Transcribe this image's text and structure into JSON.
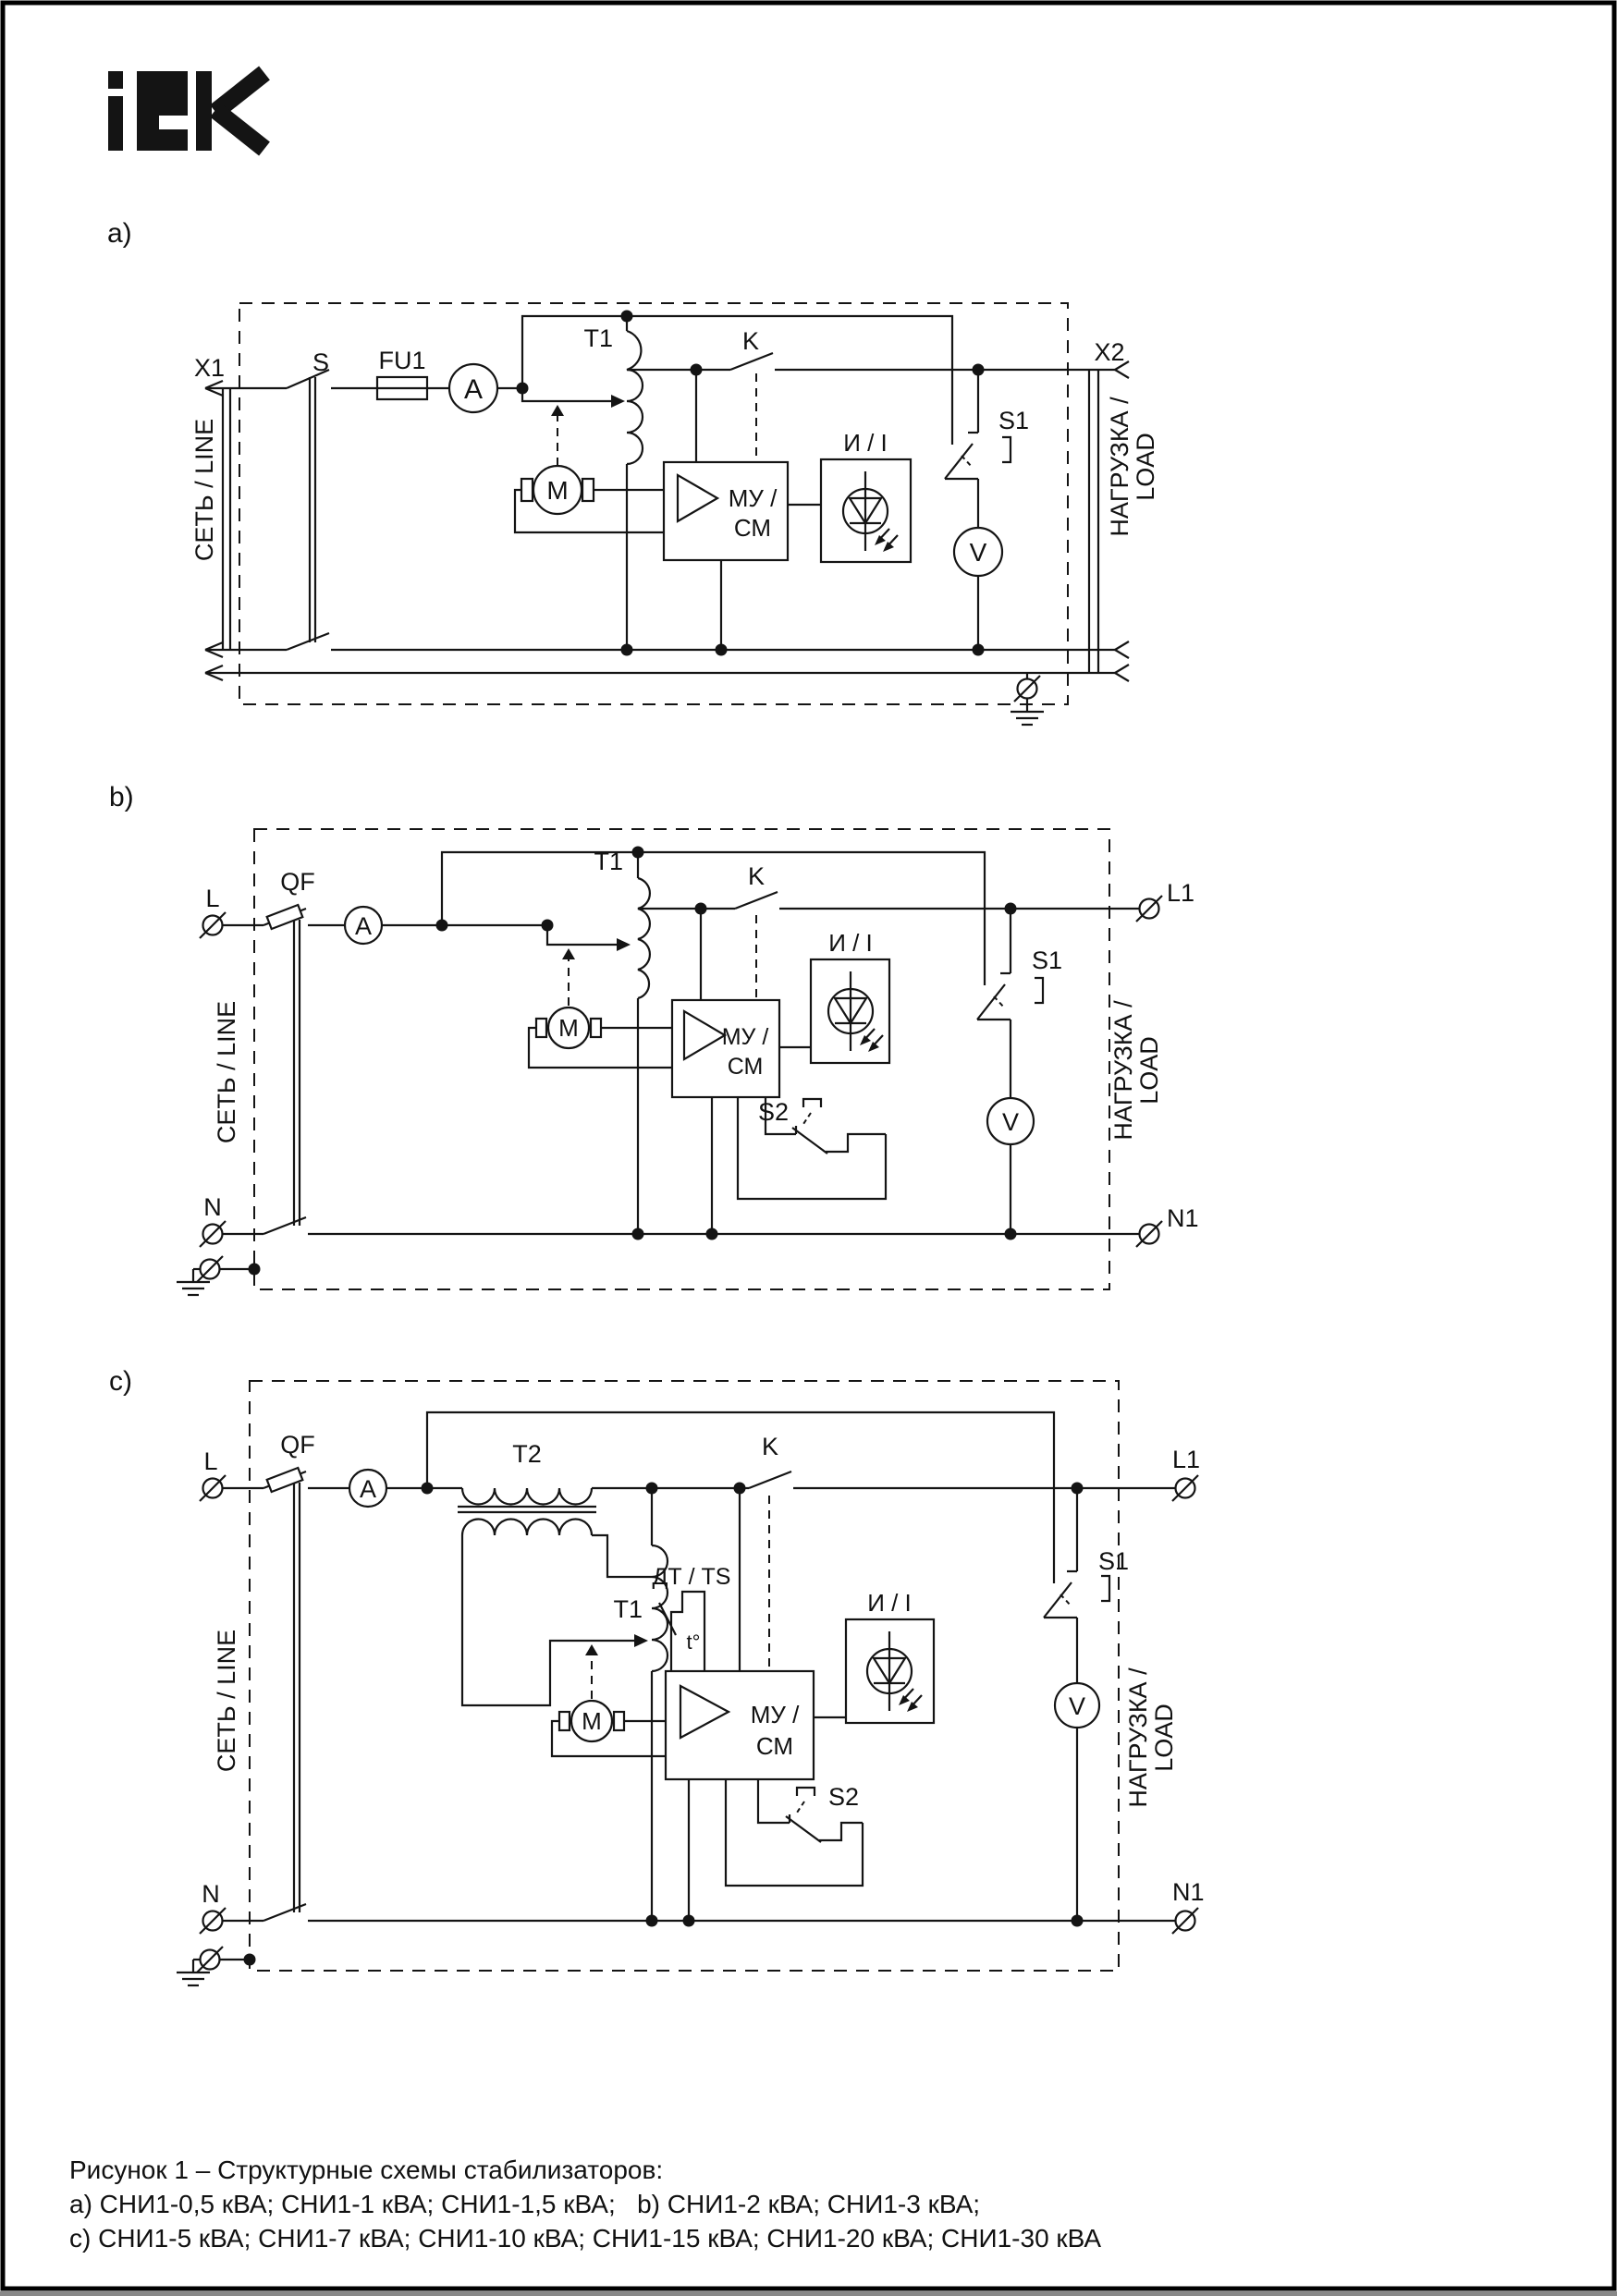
{
  "page": {
    "logo_text": "IEK",
    "caption": {
      "line1": "Рисунок 1 – Структурные схемы стабилизаторов:",
      "line2": "a) СНИ1-0,5 кВА; СНИ1-1 кВА; СНИ1-1,5 кВА;   b) СНИ1-2 кВА; СНИ1-3 кВА;",
      "line3": "c) СНИ1-5 кВА; СНИ1-7 кВА; СНИ1-10 кВА; СНИ1-15 кВА; СНИ1-20 кВА; СНИ1-30 кВА"
    }
  },
  "diagram_a": {
    "label": "a)",
    "x1": "X1",
    "s": "S",
    "fu1": "FU1",
    "ammeter": "A",
    "t1": "T1",
    "k": "K",
    "motor": "М",
    "mu1": "МУ /",
    "mu2": "СМ",
    "indicator": "И / I",
    "s1": "S1",
    "voltmeter": "V",
    "x2": "X2",
    "line_label": "СЕТЬ / LINE",
    "load_label1": "НАГРУЗКА /",
    "load_label2": "LOAD"
  },
  "diagram_b": {
    "label": "b)",
    "l": "L",
    "n": "N",
    "qf": "QF",
    "ammeter": "A",
    "t1": "T1",
    "k": "K",
    "motor": "М",
    "mu1": "МУ /",
    "mu2": "СМ",
    "indicator": "И / I",
    "s1": "S1",
    "s2": "S2",
    "voltmeter": "V",
    "l1": "L1",
    "n1": "N1",
    "line_label": "СЕТЬ / LINE",
    "load_label1": "НАГРУЗКА /",
    "load_label2": "LOAD"
  },
  "diagram_c": {
    "label": "c)",
    "l": "L",
    "n": "N",
    "qf": "QF",
    "ammeter": "A",
    "t2": "T2",
    "t1": "T1",
    "dt_ts": "ДТ / TS",
    "t_deg": "t°",
    "k": "K",
    "motor": "М",
    "mu1": "МУ /",
    "mu2": "СМ",
    "indicator": "И / I",
    "s1": "S1",
    "s2": "S2",
    "voltmeter": "V",
    "l1": "L1",
    "n1": "N1",
    "line_label": "СЕТЬ / LINE",
    "load_label1": "НАГРУЗКА /",
    "load_label2": "LOAD"
  }
}
